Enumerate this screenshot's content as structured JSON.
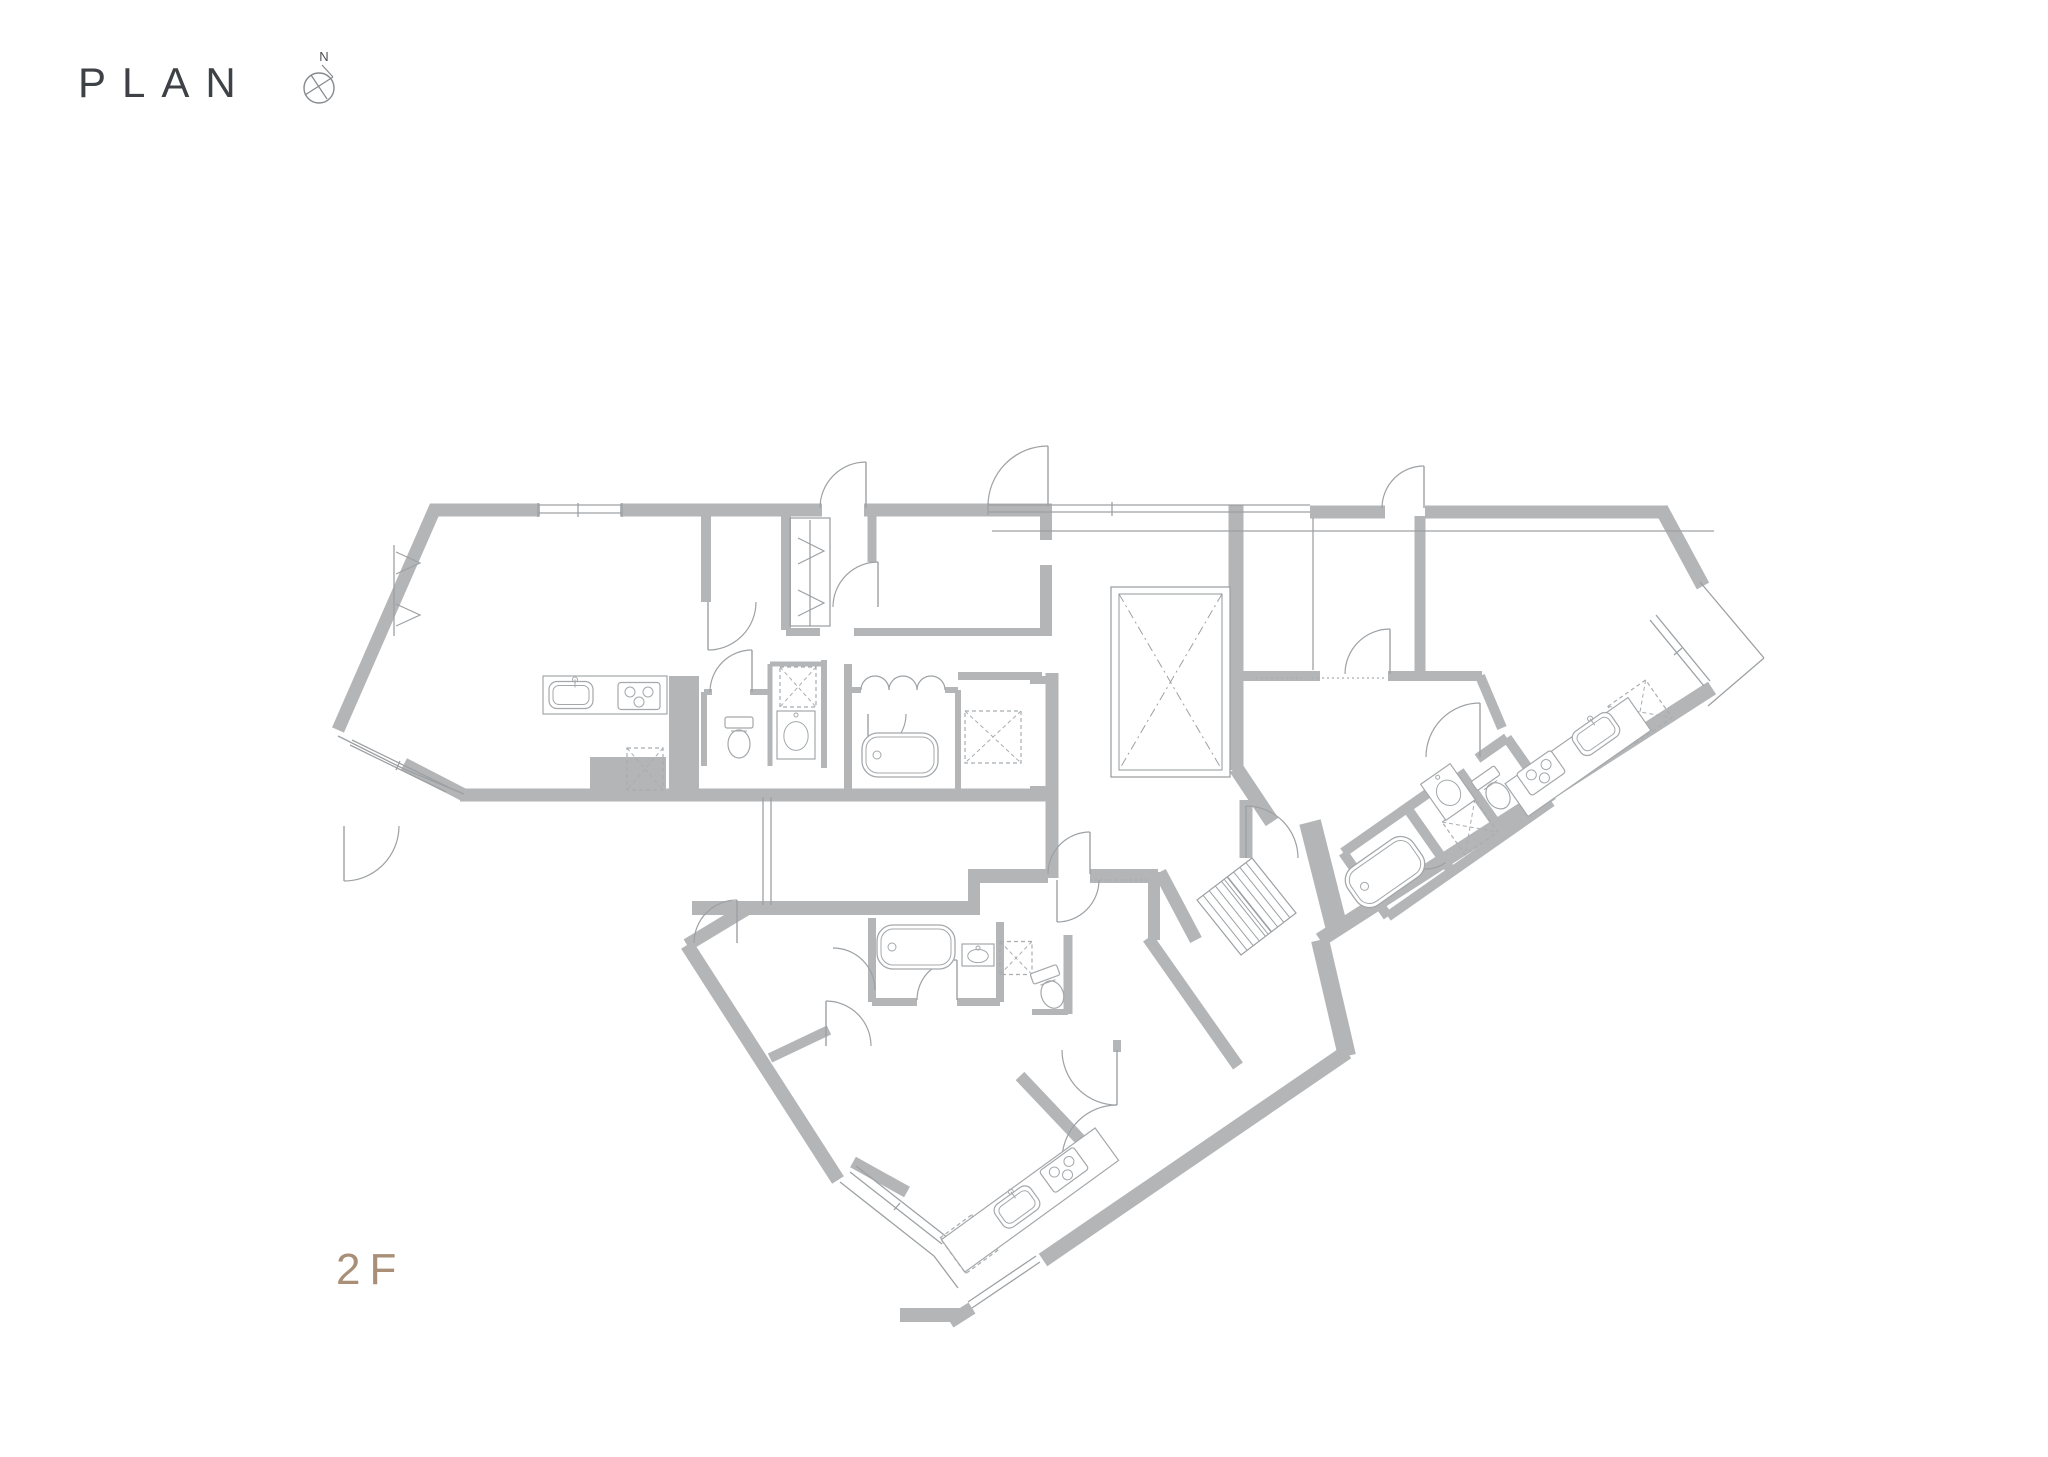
{
  "page": {
    "title": "PLAN",
    "compass_label": "N",
    "floor_label": "2F"
  },
  "colors": {
    "wall": "#b3b5b7",
    "line": "#9da1a4",
    "fixture": "#a4a8ab",
    "dash": "#a9adb0",
    "text": "#3e4246",
    "accent": "#a98f77",
    "compass": "#86898c"
  },
  "plan": {
    "walls": [
      {
        "d": "M430 510 H540",
        "w": 13
      },
      {
        "d": "M620 510 H822",
        "w": 13
      },
      {
        "d": "M864 510 H1052",
        "w": 13
      },
      {
        "d": "M436 506 L338 730",
        "w": 13
      },
      {
        "d": "M404 764 L466 796",
        "w": 13
      },
      {
        "d": "M460 795 H1058",
        "w": 13
      },
      {
        "d": "M590 776 H666",
        "w": 38
      },
      {
        "d": "M706 516 V602",
        "w": 10
      },
      {
        "d": "M786 516 V630",
        "w": 10
      },
      {
        "d": "M1046 516 V540",
        "w": 12
      },
      {
        "d": "M1046 565 V632",
        "w": 12
      },
      {
        "d": "M786 632 H820",
        "w": 8
      },
      {
        "d": "M854 632 H1052",
        "w": 8
      },
      {
        "d": "M872 510 V562",
        "w": 9
      },
      {
        "d": "M684 676 V795",
        "w": 30
      },
      {
        "d": "M704 692 H712",
        "w": 6
      },
      {
        "d": "M750 692 H770",
        "w": 6
      },
      {
        "d": "M704 692 V766",
        "w": 6
      },
      {
        "d": "M770 664 V766",
        "w": 5
      },
      {
        "d": "M824 660 V768",
        "w": 6
      },
      {
        "d": "M770 664 H824",
        "w": 5
      },
      {
        "d": "M848 664 V798",
        "w": 8
      },
      {
        "d": "M848 690 H861",
        "w": 6
      },
      {
        "d": "M945 690 H958",
        "w": 6
      },
      {
        "d": "M958 690 V795",
        "w": 6
      },
      {
        "d": "M958 676 H1042",
        "w": 8
      },
      {
        "d": "M1052 673 V795",
        "w": 13
      },
      {
        "d": "M1030 680 H1046",
        "w": 8
      },
      {
        "d": "M1030 790 H1046",
        "w": 8
      },
      {
        "d": "M1236 505 V770",
        "w": 15
      },
      {
        "d": "M1236 768 L1272 822",
        "w": 15
      },
      {
        "d": "M1246 800 V858",
        "w": 13
      },
      {
        "d": "M1160 872 L1196 940",
        "w": 13
      },
      {
        "d": "M1320 940 L1347 1056",
        "w": 18
      },
      {
        "d": "M1310 822 L1336 925",
        "w": 22
      },
      {
        "d": "M1310 512 H1385",
        "w": 13
      },
      {
        "d": "M1425 512 H1668",
        "w": 13
      },
      {
        "d": "M1662 510 L1703 586",
        "w": 14
      },
      {
        "d": "M1712 688 L1320 940",
        "w": 15
      },
      {
        "d": "M1420 516 V672",
        "w": 11
      },
      {
        "d": "M1236 676 H1320",
        "w": 10
      },
      {
        "d": "M1388 676 H1482",
        "w": 10
      },
      {
        "d": "M1480 676 L1502 728",
        "w": 10
      },
      {
        "d": "M692 908 H980",
        "w": 14
      },
      {
        "d": "M750 907 L687 945",
        "w": 13
      },
      {
        "d": "M687 945 L838 1180",
        "w": 14
      },
      {
        "d": "M853 1162 L907 1192",
        "w": 12
      },
      {
        "d": "M900 1315 H962",
        "w": 14
      },
      {
        "d": "M972 1308 L950 1322",
        "w": 13
      },
      {
        "d": "M1347 1052 L1043 1260",
        "w": 15
      },
      {
        "d": "M974 878 V912",
        "w": 12
      },
      {
        "d": "M968 876 H1048",
        "w": 14
      },
      {
        "d": "M1090 876 H1158",
        "w": 14
      },
      {
        "d": "M1154 872 V940",
        "w": 12
      },
      {
        "d": "M1148 938 L1238 1066",
        "w": 12
      },
      {
        "d": "M872 918 V1002",
        "w": 8
      },
      {
        "d": "M1000 922 V1002",
        "w": 8
      },
      {
        "d": "M872 1002 H917",
        "w": 8
      },
      {
        "d": "M957 1002 H1000",
        "w": 8
      },
      {
        "d": "M1068 935 V1014",
        "w": 9
      },
      {
        "d": "M1032 1012 H1068",
        "w": 6
      },
      {
        "d": "M770 1058 L829 1030",
        "w": 10
      },
      {
        "d": "M1020 1076 L1092 1152",
        "w": 12
      },
      {
        "d": "M1117 1040 V1052",
        "w": 8
      },
      {
        "d": "M1052 795 V878",
        "w": 13
      }
    ],
    "rot_walls": [
      {
        "t": "translate(1448,828) rotate(-35)",
        "paths": [
          "M-100 -40 H28",
          "M64 -40 H100",
          "M-100 38 H100",
          "M-100 -40 V38",
          "M100 -40 V38",
          "M-22 -40 V38",
          "M42 -40 V38"
        ]
      }
    ],
    "thin": [
      "M538 505 H622",
      "M538 513 H622",
      "M538 503 V517",
      "M622 503 V517",
      "M578 503 V517",
      "M988 505 H1310",
      "M988 512 H1310",
      "M1112 502 V516",
      "M988 503 V515",
      "M992 531 H1714",
      "M338 736 L404 769",
      "M404 769 L464 794",
      "M352 740 L448 787",
      "M350 745 L446 792",
      "M400 761 L396 770",
      "M1700 582 L1764 658",
      "M1764 658 L1708 706",
      "M1650 620 L1704 686",
      "M1656 615 L1710 681",
      "M1674 655 L1682 648",
      "M840 1182 L934 1256",
      "M934 1256 L958 1288",
      "M850 1172 L942 1244",
      "M856 1166 L948 1238",
      "M894 1210 L900 1203",
      "M1040 1262 L972 1308",
      "M1036 1256 L968 1302",
      "M763 797 V905",
      "M771 797 V905",
      "M1313 518 V670",
      "M810 520 V626",
      "M394 545 V636",
      "M790 518 H830 V626 H790 Z"
    ],
    "dashed_lines": [
      "M1312 678 H1386",
      "M1256 678 H1302",
      "M1090 880 H1148"
    ],
    "chevrons": [
      "M798 538 L824 551 L798 564",
      "M798 590 L824 603 L798 616",
      "M396 552 L420 563 L396 574",
      "M396 604 L420 615 L396 626"
    ],
    "scallops": [
      "M861 690 A14 14 0 0 1 889 690",
      "M889 690 A14 14 0 0 1 917 690",
      "M917 690 A14 14 0 0 1 945 690"
    ],
    "arcs": [
      {
        "d": "M820 508 A46 46 0 0 1 866 462",
        "leaf": "M866 508 L866 462"
      },
      {
        "d": "M988 506 A60 60 0 0 1 1048 446",
        "leaf": "M1048 506 L1048 446"
      },
      {
        "d": "M1382 508 A42 42 0 0 1 1424 466",
        "leaf": "M1424 508 L1424 466"
      },
      {
        "d": "M833 607 A45 45 0 0 1 878 562",
        "leaf": "M878 607 L878 562"
      },
      {
        "d": "M756 602 A48 48 0 0 1 708 650",
        "leaf": "M708 602 L708 650"
      },
      {
        "d": "M710 692 A42 42 0 0 1 752 650",
        "leaf": "M752 692 L752 650"
      },
      {
        "d": "M906 714 A38 38 0 0 1 868 752",
        "leaf": "M868 714 L868 752"
      },
      {
        "d": "M1298 858 A52 52 0 0 0 1246 806",
        "leaf": "M1246 858 L1246 806"
      },
      {
        "d": "M1345 674 A45 45 0 0 1 1390 629",
        "leaf": "M1390 674 L1390 629"
      },
      {
        "d": "M1480 703 A54 54 0 0 0 1426 757",
        "leaf": "M1480 757 L1480 703"
      },
      {
        "d": "M694 943 A43 43 0 0 1 737 900",
        "leaf": "M737 943 L737 900"
      },
      {
        "d": "M1048 874 A42 42 0 0 1 1090 832",
        "leaf": "M1090 874 L1090 832"
      },
      {
        "d": "M1099 880 A42 42 0 0 1 1057 922",
        "leaf": "M1057 880 L1057 922"
      },
      {
        "d": "M917 1000 A40 40 0 0 1 957 960",
        "leaf": "M957 1000 L957 960"
      },
      {
        "d": "M826 1001 A45 45 0 0 1 871 1046",
        "leaf": "M826 1046 L826 1001"
      },
      {
        "d": "M1062 1050 A55 55 0 0 0 1117 1105",
        "leaf": "M1117 1050 L1117 1105"
      },
      {
        "d": "M1117 1105 A55 55 0 0 0 1062 1160",
        "leaf": "M1117 1160 L1062 1160"
      },
      {
        "d": "M399 826 A55 55 0 0 1 344 881",
        "leaf": "M344 826 L344 881"
      },
      {
        "d": "M833 948 A42 42 0 0 1 875 990",
        "leaf": ""
      }
    ],
    "rot_arcs": [
      {
        "t": "translate(1448,828) rotate(-35)",
        "d": "M-57 -8 A35 35 0 0 0 -22 27",
        "leaf": ""
      }
    ],
    "washers": [
      {
        "cx": 645,
        "cy": 769,
        "w": 36,
        "h": 42,
        "rot": 0
      },
      {
        "cx": 798,
        "cy": 687,
        "w": 36,
        "h": 40,
        "rot": 0
      },
      {
        "cx": 993,
        "cy": 737,
        "w": 56,
        "h": 52,
        "rot": 0
      },
      {
        "cx": 1640,
        "cy": 712,
        "w": 46,
        "h": 46,
        "rot": -35
      },
      {
        "cx": 969,
        "cy": 1244,
        "w": 40,
        "h": 44,
        "rot": -36
      },
      {
        "cx": 1016,
        "cy": 958,
        "w": 32,
        "h": 33,
        "rot": 0
      },
      {
        "cx": 1470,
        "cy": 827,
        "w": 40,
        "h": 40,
        "rot": -35
      }
    ],
    "elevator": {
      "x": 1111,
      "y": 587,
      "w": 119,
      "h": 190,
      "ix": 1119,
      "iy": 594,
      "iw": 103,
      "ih": 176
    },
    "stairs": {
      "a": [
        1197,
        900
      ],
      "b": [
        1252,
        858
      ],
      "c": [
        1296,
        913
      ],
      "d": [
        1241,
        955
      ],
      "treads": 9,
      "rail1": "M1224 879 L1268 934",
      "rail2": "M1227 877 L1271 932"
    },
    "fixtures": [
      {
        "type": "counter",
        "cx": 605,
        "cy": 695,
        "w": 124,
        "h": 38,
        "rot": 0
      },
      {
        "type": "ksink",
        "cx": 571,
        "cy": 695,
        "w": 44,
        "h": 27,
        "rot": 0
      },
      {
        "type": "stove",
        "cx": 639,
        "cy": 696,
        "w": 42,
        "h": 27,
        "rot": 0
      },
      {
        "type": "counter",
        "cx": 1578,
        "cy": 757,
        "w": 150,
        "h": 40,
        "rot": -35
      },
      {
        "type": "ksink",
        "cx": 1596,
        "cy": 734,
        "w": 46,
        "h": 28,
        "rot": -35
      },
      {
        "type": "stove",
        "cx": 1541,
        "cy": 773,
        "w": 42,
        "h": 27,
        "rot": -35
      },
      {
        "type": "counter",
        "cx": 1030,
        "cy": 1200,
        "w": 190,
        "h": 40,
        "rot": -36
      },
      {
        "type": "ksink",
        "cx": 1017,
        "cy": 1207,
        "w": 44,
        "h": 28,
        "rot": -36
      },
      {
        "type": "stove",
        "cx": 1064,
        "cy": 1170,
        "w": 42,
        "h": 27,
        "rot": -36
      },
      {
        "type": "bathtub",
        "cx": 900,
        "cy": 755,
        "w": 76,
        "h": 44,
        "rot": 0
      },
      {
        "type": "bathtub",
        "cx": 1385,
        "cy": 872,
        "w": 80,
        "h": 46,
        "rot": -35
      },
      {
        "type": "bathtub",
        "cx": 916,
        "cy": 947,
        "w": 78,
        "h": 44,
        "rot": 0
      },
      {
        "type": "toilet",
        "cx": 739,
        "cy": 737,
        "w": 30,
        "h": 40,
        "rot": 0
      },
      {
        "type": "toilet",
        "cx": 1494,
        "cy": 790,
        "w": 30,
        "h": 40,
        "rot": -35
      },
      {
        "type": "toilet",
        "cx": 1050,
        "cy": 988,
        "w": 30,
        "h": 40,
        "rot": -20
      },
      {
        "type": "vanity",
        "cx": 796,
        "cy": 735,
        "w": 38,
        "h": 48,
        "rot": 0
      },
      {
        "type": "vanity",
        "cx": 1448,
        "cy": 792,
        "w": 36,
        "h": 44,
        "rot": -35
      },
      {
        "type": "vanity",
        "cx": 978,
        "cy": 955,
        "w": 32,
        "h": 22,
        "rot": 0
      }
    ]
  }
}
